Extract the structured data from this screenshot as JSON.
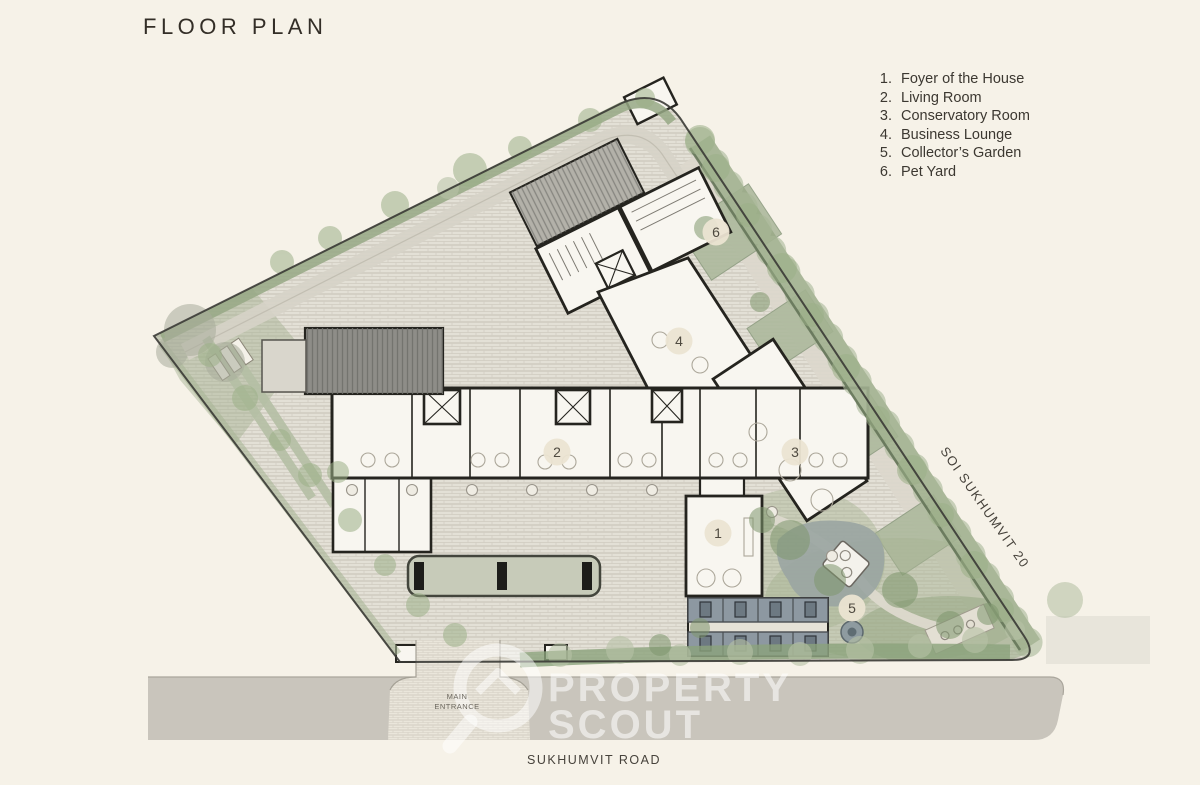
{
  "page": {
    "title": "FLOOR PLAN"
  },
  "legend": {
    "items": [
      {
        "num": "1.",
        "label": "Foyer of the House"
      },
      {
        "num": "2.",
        "label": "Living Room"
      },
      {
        "num": "3.",
        "label": "Conservatory Room"
      },
      {
        "num": "4.",
        "label": "Business Lounge"
      },
      {
        "num": "5.",
        "label": "Collector’s Garden"
      },
      {
        "num": "6.",
        "label": "Pet Yard"
      }
    ]
  },
  "plan": {
    "labels": {
      "road": "SUKHUMVIT ROAD",
      "soi": "SOI SUKHUMVIT 20",
      "entrance_line1": "MAIN",
      "entrance_line2": "ENTRANCE"
    },
    "markers": [
      {
        "n": "1",
        "x": 718,
        "y": 533
      },
      {
        "n": "2",
        "x": 557,
        "y": 452
      },
      {
        "n": "3",
        "x": 795,
        "y": 452
      },
      {
        "n": "4",
        "x": 679,
        "y": 341
      },
      {
        "n": "5",
        "x": 852,
        "y": 608
      },
      {
        "n": "6",
        "x": 716,
        "y": 232
      }
    ]
  },
  "watermark": {
    "line1": "PROPERTY",
    "line2": "SCOUT"
  },
  "colors": {
    "bg": "#f6f2e8",
    "paving": "#e3e0d6",
    "road": "#c9c5bc",
    "hedge": "#97a885",
    "hedge_dark": "#5e6e52",
    "wall": "#25241f",
    "room": "#f8f6f0",
    "water": "#9aa5a2",
    "canopy": "#c7cbb9",
    "slab": "#8e8d88",
    "marker_fill": "#ebe4d2",
    "text_dark": "#332e27",
    "text_mid": "#46423b"
  }
}
